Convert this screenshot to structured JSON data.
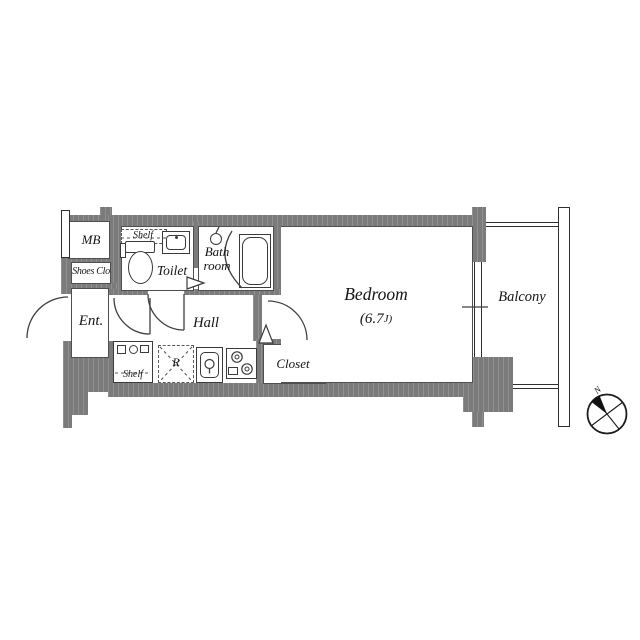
{
  "rooms": {
    "mb": "MB",
    "shoes_closet": "Shoes Clo",
    "entrance": "Ent.",
    "toilet": "Toilet",
    "bath_line1": "Bath",
    "bath_line2": "room",
    "hall": "Hall",
    "closet": "Closet",
    "bedroom": "Bedroom",
    "bedroom_area_main": "(6.7",
    "bedroom_area_unit": "J)",
    "balcony": "Balcony"
  },
  "fixtures": {
    "refrigerator": "R",
    "shelf_toilet": "Shelf",
    "shelf_laundry": "Shelf"
  },
  "compass": {
    "north": "N"
  },
  "colors": {
    "wall": "#7b7b7b",
    "line": "#3f3f3f",
    "text": "#141414",
    "background": "#ffffff"
  }
}
